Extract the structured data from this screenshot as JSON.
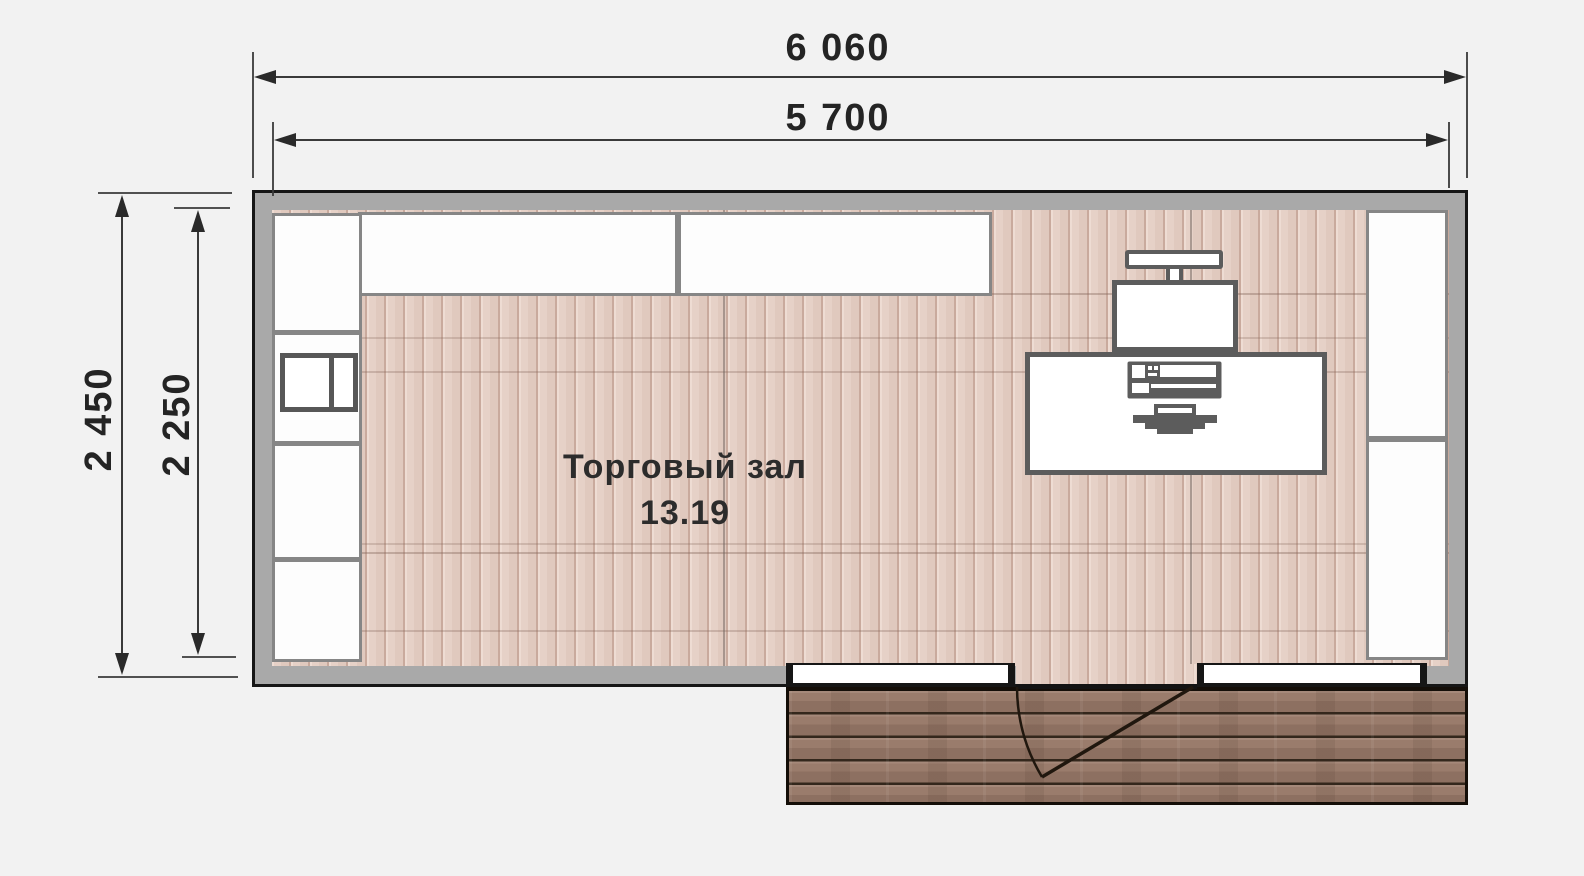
{
  "canvas": {
    "background": "#f2f2f2"
  },
  "dimension_labels": {
    "top_outer": "6 060",
    "top_inner": "5 700",
    "left_outer": "2 450",
    "left_inner": "2 250"
  },
  "room": {
    "name": "Торговый зал",
    "area": "13.19"
  },
  "palette": {
    "wall_fill": "#a9a9a9",
    "wall_outline": "#161616",
    "floor_wood": "#e4cfc5",
    "floor_plank_line": "#c9aa9d",
    "deck_wood": "#97796a",
    "deck_plank_line": "#33271c",
    "unit_outline": "#868686",
    "desk_outline": "#5c5c5c",
    "dimension_line": "#3a3a3a",
    "label_text": "#242424"
  },
  "icons": {
    "monitor": "monitor-icon",
    "terminal": "terminal-icon",
    "pos_keyboard": "pos-keyboard-icon",
    "desk_device": "desk-device-icon",
    "door_swing": "door-swing-icon",
    "dimension_arrow": "dimension-arrow-icon"
  }
}
